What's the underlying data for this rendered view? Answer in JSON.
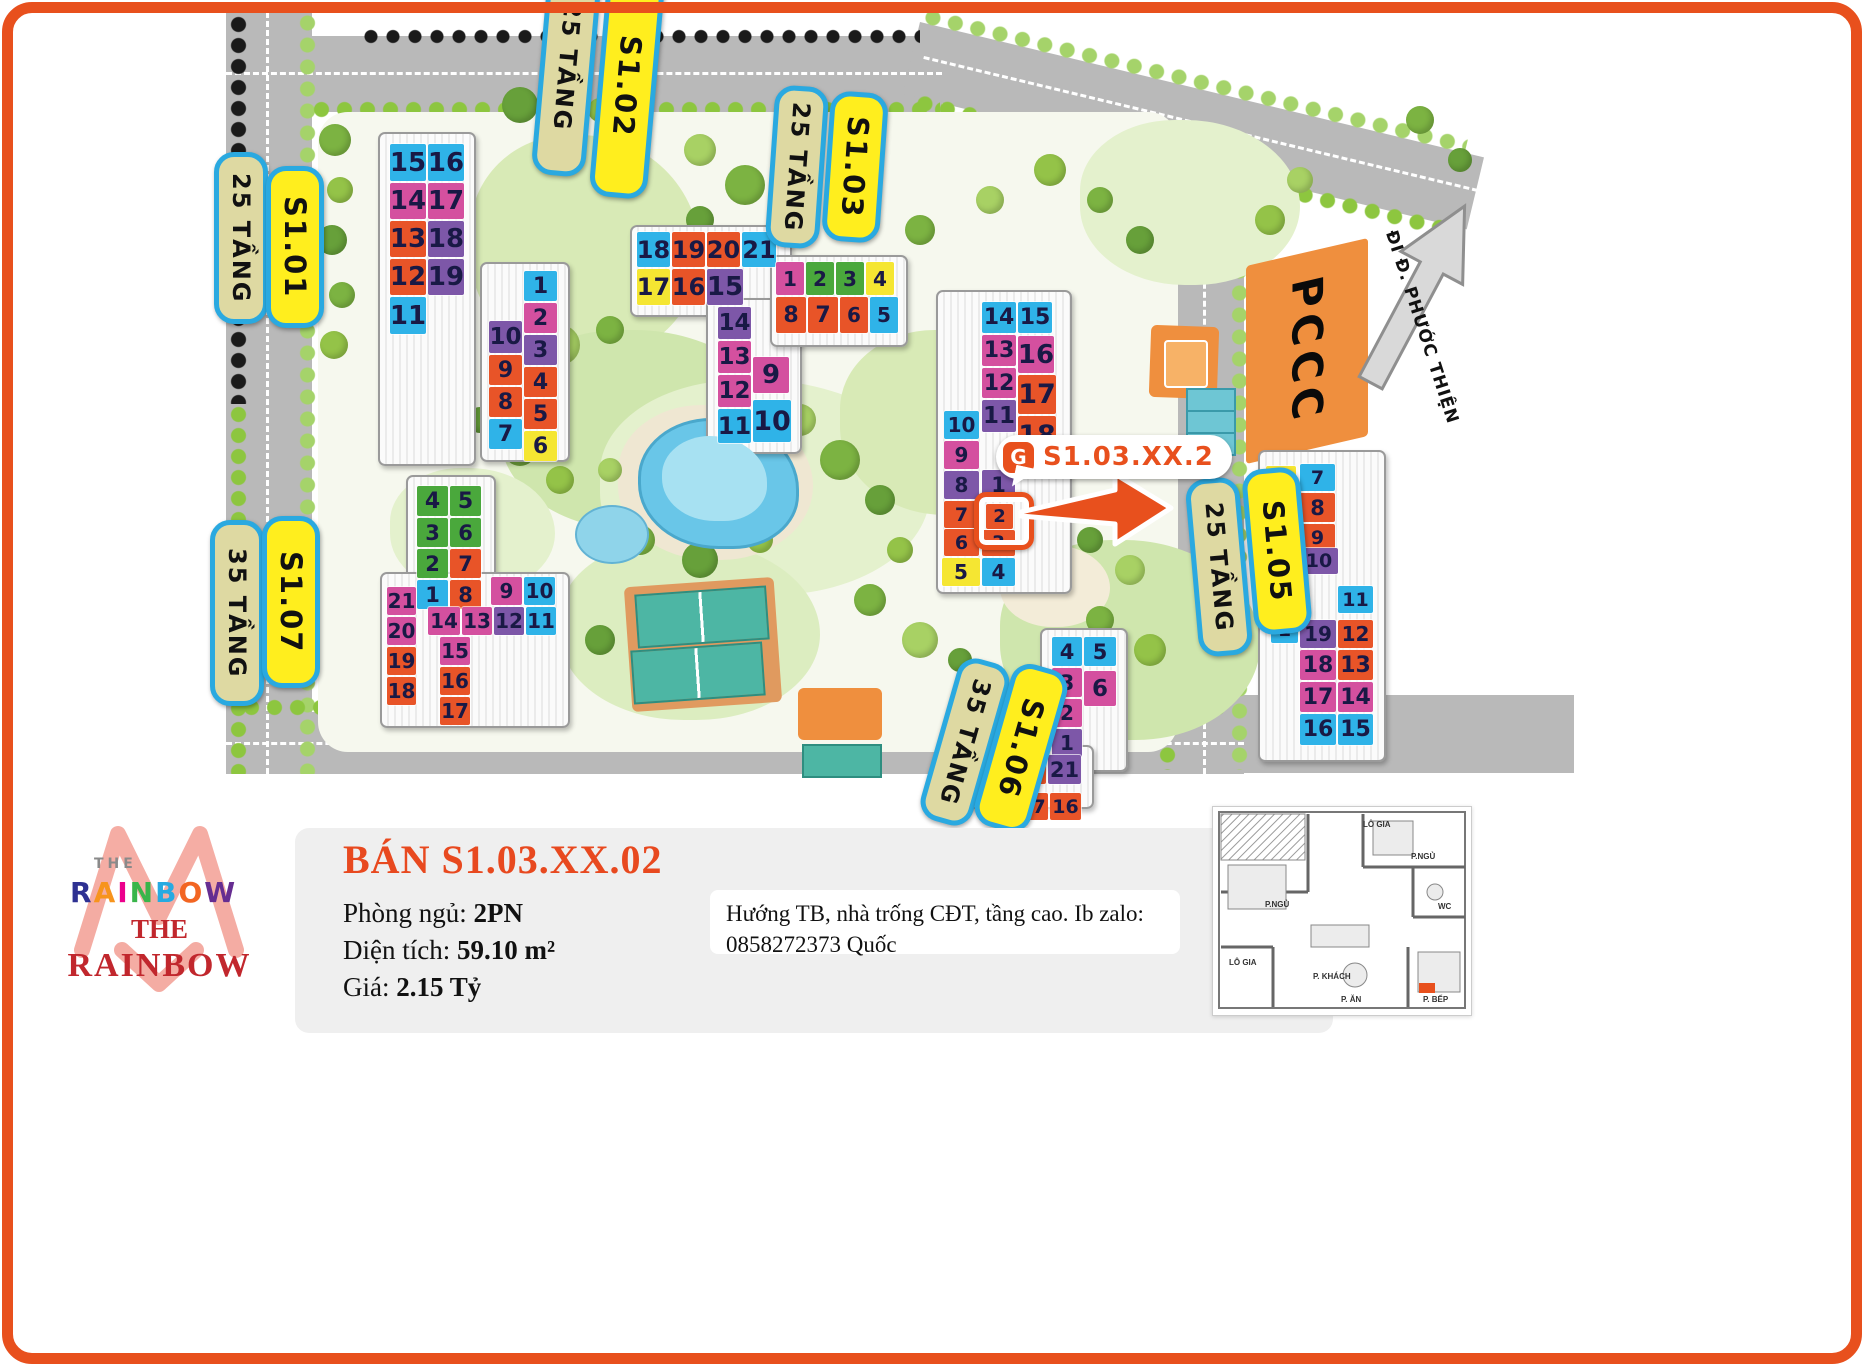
{
  "map": {
    "street_label": "ĐI Đ. PHƯỚC THIỆN",
    "pccc_label": "PCCC",
    "callout": {
      "icon": "brand-g-icon",
      "icon_glyph": "G",
      "text": "S1.03.XX.2"
    },
    "pill_border_color": "#2aa9e0",
    "pills": [
      {
        "id": "s101-floors",
        "text": "25 TẦNG",
        "variant": "khaki",
        "x": 214,
        "y": 152,
        "h": 162,
        "rot": 0
      },
      {
        "id": "s101",
        "text": "S1.01",
        "variant": "yellow",
        "x": 266,
        "y": 166,
        "h": 152,
        "rot": 0
      },
      {
        "id": "s102-floors",
        "text": "25 TẦNG",
        "variant": "khaki",
        "x": 540,
        "y": -44,
        "h": 210,
        "rot": 5
      },
      {
        "id": "s102",
        "text": "S1.02",
        "variant": "yellow",
        "x": 598,
        "y": -26,
        "h": 214,
        "rot": 5
      },
      {
        "id": "s103-floors",
        "text": "25 TẦNG",
        "variant": "khaki",
        "x": 770,
        "y": 86,
        "h": 152,
        "rot": 4
      },
      {
        "id": "s103",
        "text": "S1.03",
        "variant": "yellow",
        "x": 826,
        "y": 92,
        "h": 140,
        "rot": 4
      },
      {
        "id": "s105-floors",
        "text": "25 TẦNG",
        "variant": "khaki",
        "x": 1192,
        "y": 478,
        "h": 168,
        "rot": -5
      },
      {
        "id": "s105",
        "text": "S1.05",
        "variant": "yellow",
        "x": 1248,
        "y": 468,
        "h": 156,
        "rot": -5
      },
      {
        "id": "s107-floors",
        "text": "35 TẦNG",
        "variant": "khaki",
        "x": 210,
        "y": 520,
        "h": 176,
        "rot": 0
      },
      {
        "id": "s107",
        "text": "S1.07",
        "variant": "yellow",
        "x": 262,
        "y": 516,
        "h": 162,
        "rot": 0
      },
      {
        "id": "s106-floors",
        "text": "35 TẦNG",
        "variant": "khaki",
        "x": 938,
        "y": 658,
        "h": 158,
        "rot": 16
      },
      {
        "id": "s106",
        "text": "S1.06",
        "variant": "yellow",
        "x": 992,
        "y": 664,
        "h": 158,
        "rot": 16
      }
    ],
    "tile_colors": {
      "blue": "#2fb3e8",
      "magenta": "#d4509f",
      "orange": "#e85428",
      "purple": "#7d57a8",
      "yellow": "#f5e632",
      "green": "#4aa83c",
      "number_text": "#191945",
      "highlight_ring": "#e8501d"
    },
    "tile_fields": [
      "building",
      "unit",
      "color",
      "x",
      "y",
      "w",
      "h",
      "highlight"
    ],
    "tiles": [
      [
        "S1.01",
        15,
        "blue",
        390,
        144,
        36,
        37
      ],
      [
        "S1.01",
        16,
        "blue",
        428,
        144,
        36,
        37
      ],
      [
        "S1.01",
        14,
        "magenta",
        390,
        183,
        36,
        36
      ],
      [
        "S1.01",
        17,
        "magenta",
        428,
        183,
        36,
        36
      ],
      [
        "S1.01",
        13,
        "orange",
        390,
        221,
        36,
        36
      ],
      [
        "S1.01",
        18,
        "purple",
        428,
        221,
        36,
        36
      ],
      [
        "S1.01",
        12,
        "orange",
        390,
        259,
        36,
        36
      ],
      [
        "S1.01",
        19,
        "purple",
        428,
        259,
        36,
        36
      ],
      [
        "S1.01",
        11,
        "blue",
        390,
        297,
        36,
        37
      ],
      [
        "S1.01",
        1,
        "blue",
        524,
        271,
        33,
        30
      ],
      [
        "S1.01",
        2,
        "magenta",
        524,
        303,
        33,
        30
      ],
      [
        "S1.01",
        10,
        "purple",
        489,
        321,
        33,
        32
      ],
      [
        "S1.01",
        3,
        "purple",
        524,
        335,
        33,
        30
      ],
      [
        "S1.01",
        9,
        "orange",
        489,
        355,
        33,
        30
      ],
      [
        "S1.01",
        4,
        "orange",
        524,
        367,
        33,
        30
      ],
      [
        "S1.01",
        8,
        "orange",
        489,
        387,
        33,
        30
      ],
      [
        "S1.01",
        5,
        "orange",
        524,
        399,
        33,
        30
      ],
      [
        "S1.01",
        7,
        "blue",
        489,
        419,
        33,
        30
      ],
      [
        "S1.01",
        6,
        "yellow",
        524,
        431,
        33,
        30
      ],
      [
        "S1.02",
        18,
        "blue",
        637,
        232,
        33,
        35
      ],
      [
        "S1.02",
        19,
        "orange",
        672,
        232,
        33,
        35
      ],
      [
        "S1.02",
        20,
        "orange",
        707,
        232,
        33,
        35
      ],
      [
        "S1.02",
        21,
        "blue",
        742,
        232,
        34,
        35
      ],
      [
        "S1.02",
        17,
        "yellow",
        637,
        269,
        33,
        36
      ],
      [
        "S1.02",
        16,
        "orange",
        672,
        269,
        33,
        36
      ],
      [
        "S1.02",
        15,
        "purple",
        707,
        269,
        36,
        36
      ],
      [
        "S1.02",
        14,
        "purple",
        718,
        307,
        33,
        32
      ],
      [
        "S1.02",
        13,
        "magenta",
        718,
        341,
        33,
        32
      ],
      [
        "S1.02",
        12,
        "magenta",
        718,
        375,
        33,
        32
      ],
      [
        "S1.02",
        11,
        "blue",
        718,
        409,
        33,
        34
      ],
      [
        "S1.02",
        9,
        "magenta",
        753,
        357,
        36,
        36
      ],
      [
        "S1.02",
        10,
        "blue",
        753,
        400,
        38,
        42
      ],
      [
        "S1.02",
        1,
        "magenta",
        776,
        262,
        28,
        33
      ],
      [
        "S1.02",
        2,
        "green",
        806,
        262,
        28,
        33
      ],
      [
        "S1.02",
        3,
        "green",
        836,
        262,
        28,
        33
      ],
      [
        "S1.02",
        4,
        "yellow",
        866,
        262,
        28,
        33
      ],
      [
        "S1.02",
        8,
        "orange",
        776,
        297,
        30,
        36
      ],
      [
        "S1.02",
        7,
        "orange",
        808,
        297,
        30,
        36
      ],
      [
        "S1.02",
        6,
        "orange",
        840,
        297,
        28,
        36
      ],
      [
        "S1.02",
        5,
        "blue",
        870,
        297,
        28,
        36
      ],
      [
        "S1.03",
        14,
        "blue",
        982,
        302,
        34,
        31
      ],
      [
        "S1.03",
        15,
        "blue",
        1018,
        302,
        34,
        31
      ],
      [
        "S1.03",
        13,
        "magenta",
        982,
        335,
        34,
        31
      ],
      [
        "S1.03",
        16,
        "magenta",
        1018,
        336,
        36,
        37
      ],
      [
        "S1.03",
        12,
        "magenta",
        982,
        368,
        34,
        30
      ],
      [
        "S1.03",
        17,
        "orange",
        1018,
        375,
        38,
        39
      ],
      [
        "S1.03",
        11,
        "purple",
        982,
        400,
        34,
        32
      ],
      [
        "S1.03",
        18,
        "orange",
        1018,
        416,
        38,
        39
      ],
      [
        "S1.03",
        10,
        "blue",
        944,
        411,
        35,
        28
      ],
      [
        "S1.03",
        9,
        "magenta",
        944,
        441,
        35,
        28
      ],
      [
        "S1.03",
        8,
        "purple",
        944,
        471,
        35,
        28
      ],
      [
        "S1.03",
        1,
        "purple",
        982,
        470,
        33,
        29
      ],
      [
        "S1.03",
        7,
        "orange",
        944,
        501,
        35,
        27
      ],
      [
        "S1.03",
        2,
        "orange",
        986,
        504,
        27,
        25,
        true
      ],
      [
        "S1.03",
        6,
        "orange",
        944,
        529,
        35,
        27
      ],
      [
        "S1.03",
        3,
        "orange",
        982,
        530,
        33,
        26
      ],
      [
        "S1.03",
        5,
        "yellow",
        942,
        558,
        38,
        28
      ],
      [
        "S1.03",
        4,
        "blue",
        982,
        558,
        33,
        28
      ],
      [
        "S1.04",
        6,
        "yellow",
        1266,
        466,
        30,
        25
      ],
      [
        "S1.04",
        7,
        "blue",
        1300,
        464,
        35,
        27
      ],
      [
        "S1.04",
        5,
        "orange",
        1266,
        493,
        30,
        29
      ],
      [
        "S1.04",
        8,
        "orange",
        1300,
        493,
        35,
        29
      ],
      [
        "S1.04",
        4,
        "orange",
        1266,
        524,
        30,
        27
      ],
      [
        "S1.04",
        9,
        "orange",
        1300,
        524,
        35,
        27
      ],
      [
        "S1.04",
        3,
        "purple",
        1266,
        553,
        30,
        28
      ],
      [
        "S1.04",
        10,
        "purple",
        1300,
        548,
        38,
        26
      ],
      [
        "S1.04",
        2,
        "magenta",
        1271,
        583,
        27,
        27
      ],
      [
        "S1.04",
        11,
        "blue",
        1338,
        586,
        35,
        27
      ],
      [
        "S1.04",
        1,
        "blue",
        1271,
        616,
        27,
        27
      ],
      [
        "S1.04",
        19,
        "purple",
        1300,
        620,
        36,
        28
      ],
      [
        "S1.04",
        12,
        "orange",
        1338,
        620,
        35,
        28
      ],
      [
        "S1.04",
        18,
        "magenta",
        1300,
        650,
        36,
        30
      ],
      [
        "S1.04",
        13,
        "orange",
        1338,
        650,
        35,
        30
      ],
      [
        "S1.04",
        17,
        "magenta",
        1300,
        682,
        36,
        30
      ],
      [
        "S1.04",
        14,
        "magenta",
        1338,
        682,
        35,
        30
      ],
      [
        "S1.04",
        16,
        "blue",
        1300,
        714,
        36,
        31
      ],
      [
        "S1.04",
        15,
        "blue",
        1338,
        714,
        35,
        31
      ],
      [
        "S1.06",
        4,
        "blue",
        1052,
        637,
        30,
        29
      ],
      [
        "S1.06",
        5,
        "blue",
        1084,
        637,
        32,
        29
      ],
      [
        "S1.06",
        3,
        "magenta",
        1052,
        668,
        30,
        29
      ],
      [
        "S1.06",
        6,
        "magenta",
        1084,
        671,
        32,
        35
      ],
      [
        "S1.06",
        2,
        "magenta",
        1052,
        699,
        30,
        28
      ],
      [
        "S1.06",
        1,
        "purple",
        1052,
        729,
        30,
        28
      ],
      [
        "S1.06",
        19,
        "yellow",
        978,
        755,
        33,
        29
      ],
      [
        "S1.06",
        20,
        "orange",
        1013,
        755,
        33,
        29
      ],
      [
        "S1.06",
        21,
        "purple",
        1048,
        755,
        33,
        29
      ],
      [
        "S1.06",
        18,
        "blue",
        984,
        793,
        31,
        27
      ],
      [
        "S1.06",
        17,
        "orange",
        1017,
        793,
        31,
        27
      ],
      [
        "S1.06",
        16,
        "orange",
        1050,
        793,
        31,
        27
      ],
      [
        "S1.07",
        4,
        "green",
        417,
        486,
        31,
        30
      ],
      [
        "S1.07",
        5,
        "green",
        450,
        486,
        31,
        30
      ],
      [
        "S1.07",
        3,
        "green",
        417,
        518,
        31,
        29
      ],
      [
        "S1.07",
        6,
        "green",
        450,
        518,
        31,
        29
      ],
      [
        "S1.07",
        2,
        "green",
        417,
        549,
        31,
        29
      ],
      [
        "S1.07",
        7,
        "orange",
        450,
        549,
        31,
        29
      ],
      [
        "S1.07",
        1,
        "blue",
        417,
        580,
        31,
        29
      ],
      [
        "S1.07",
        8,
        "orange",
        450,
        580,
        31,
        29
      ],
      [
        "S1.07",
        21,
        "magenta",
        387,
        587,
        29,
        28
      ],
      [
        "S1.07",
        9,
        "magenta",
        491,
        577,
        31,
        28
      ],
      [
        "S1.07",
        10,
        "blue",
        524,
        577,
        31,
        28
      ],
      [
        "S1.07",
        14,
        "magenta",
        428,
        607,
        32,
        28
      ],
      [
        "S1.07",
        13,
        "magenta",
        462,
        607,
        30,
        28
      ],
      [
        "S1.07",
        12,
        "purple",
        494,
        607,
        30,
        28
      ],
      [
        "S1.07",
        11,
        "blue",
        526,
        607,
        30,
        28
      ],
      [
        "S1.07",
        20,
        "magenta",
        387,
        617,
        29,
        28
      ],
      [
        "S1.07",
        15,
        "magenta",
        440,
        637,
        30,
        28
      ],
      [
        "S1.07",
        19,
        "orange",
        387,
        647,
        29,
        28
      ],
      [
        "S1.07",
        16,
        "orange",
        440,
        667,
        30,
        28
      ],
      [
        "S1.07",
        18,
        "orange",
        387,
        677,
        29,
        28
      ],
      [
        "S1.07",
        17,
        "orange",
        440,
        697,
        30,
        28
      ]
    ]
  },
  "panel": {
    "title": "BÁN S1.03.XX.02",
    "title_color": "#e8491f",
    "fields": [
      {
        "label": "Phòng ngủ: ",
        "value": "2PN"
      },
      {
        "label": "Diện tích: ",
        "value": "59.10 m²"
      },
      {
        "label": "Giá: ",
        "value": "2.15 Tỷ"
      }
    ],
    "note_line1": "Hướng TB, nhà trống CĐT, tầng cao. Ib zalo:",
    "note_line2": "0858272373 Quốc"
  },
  "logo": {
    "the_small": "THE",
    "rainbow_letters": [
      "R",
      "A",
      "I",
      "N",
      "B",
      "O",
      "W"
    ],
    "letter_colors": [
      "#2e3192",
      "#f7941d",
      "#ec008c",
      "#39b54a",
      "#27aae1",
      "#f26522",
      "#662d91"
    ],
    "the_serif": "THE",
    "rainbow_serif": "RAINBOW",
    "accent": "#c1272d",
    "mark_color": "#f2988d"
  },
  "floorplan": {
    "rooms": {
      "lo_gia_top": "LÔ GIA",
      "p_ngu_right": "P.NGỦ",
      "wc": "WC",
      "p_ngu_left": "P.NGỦ",
      "lo_gia_bottom": "LÔ GIA",
      "p_khach": "P. KHÁCH",
      "p_an": "P. ĂN",
      "p_bep": "P. BẾP"
    }
  }
}
